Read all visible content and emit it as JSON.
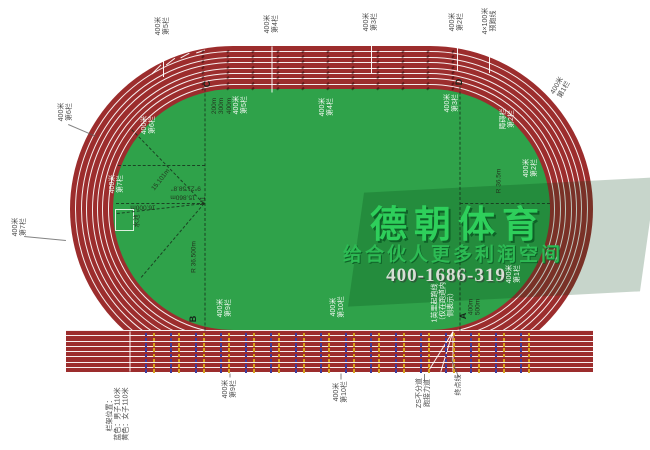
{
  "watermark": {
    "brand": "德朝体育",
    "slogan": "给合伙人更多利润空间",
    "phone": "400-1686-319"
  },
  "colors": {
    "track_red": "#9c2d2d",
    "field_green": "#2fa24a",
    "brand_green": "#2ecf5b",
    "hurdle_blue": "#3c3c9e",
    "hurdle_yellow": "#d7a31e"
  },
  "labels": [
    {
      "name": "label-400m-hurdle5-top",
      "cls": "out",
      "x": 163,
      "y": 26,
      "rot": -90,
      "lines": [
        "400米",
        "第5栏"
      ]
    },
    {
      "name": "label-400m-hurdle4-top",
      "cls": "out",
      "x": 272,
      "y": 24,
      "rot": -90,
      "lines": [
        "400米",
        "第4栏"
      ]
    },
    {
      "name": "label-400m-hurdle3-top",
      "cls": "out",
      "x": 371,
      "y": 22,
      "rot": -90,
      "lines": [
        "400米",
        "第3栏"
      ]
    },
    {
      "name": "label-400m-hurdle2-top",
      "cls": "out",
      "x": 457,
      "y": 22,
      "rot": -90,
      "lines": [
        "400米",
        "第2栏"
      ]
    },
    {
      "name": "label-4x100m-relay",
      "cls": "out",
      "x": 490,
      "y": 21,
      "rot": -90,
      "lines": [
        "4×100米",
        "预跑线"
      ]
    },
    {
      "name": "label-400m-hurdle6-left",
      "cls": "out",
      "x": 66,
      "y": 112,
      "rot": -90,
      "lines": [
        "400米",
        "第6栏"
      ]
    },
    {
      "name": "label-400m-hurdle7-left",
      "cls": "out",
      "x": 20,
      "y": 227,
      "rot": -90,
      "lines": [
        "400米",
        "第7栏"
      ]
    },
    {
      "name": "label-400m-hurdle1-track",
      "cls": "out",
      "x": 561,
      "y": 88,
      "rot": -60,
      "lines": [
        "400米",
        "第1栏"
      ]
    },
    {
      "name": "label-400m-hurdle9-bottom",
      "cls": "out",
      "x": 230,
      "y": 389,
      "rot": -90,
      "lines": [
        "400米",
        "第9栏"
      ]
    },
    {
      "name": "label-400m-hurdle10-bottom",
      "cls": "out",
      "x": 341,
      "y": 392,
      "rot": -90,
      "lines": [
        "400米",
        "第10栏"
      ]
    },
    {
      "name": "label-zs-relay-lane",
      "cls": "out",
      "x": 424,
      "y": 393,
      "rot": -90,
      "lines": [
        "ZS不分道",
        "跑接力道"
      ]
    },
    {
      "name": "label-finish-line",
      "cls": "out",
      "x": 459,
      "y": 385,
      "rot": -90,
      "lines": [
        "终点线"
      ]
    },
    {
      "name": "label-hurdle-legend",
      "cls": "out",
      "x": 118,
      "y": 414,
      "rot": -90,
      "lines": [
        "栏架位置：",
        "蓝色：男子110米",
        "黄色：女子110米"
      ]
    },
    {
      "name": "label-400m-hurdle6-in",
      "cls": "in",
      "x": 149,
      "y": 125,
      "rot": -90,
      "lines": [
        "400米",
        "第6栏"
      ]
    },
    {
      "name": "label-400m-hurdle7-in",
      "cls": "in",
      "x": 117,
      "y": 184,
      "rot": -90,
      "lines": [
        "400米",
        "第7栏"
      ]
    },
    {
      "name": "label-400m-hurdle5-in",
      "cls": "in",
      "x": 241,
      "y": 105,
      "rot": -90,
      "lines": [
        "400米",
        "第5栏"
      ]
    },
    {
      "name": "label-400m-hurdle4-in",
      "cls": "in",
      "x": 327,
      "y": 107,
      "rot": -90,
      "lines": [
        "400米",
        "第4栏"
      ]
    },
    {
      "name": "label-400m-hurdle3-in",
      "cls": "in",
      "x": 452,
      "y": 103,
      "rot": -90,
      "lines": [
        "400米",
        "第3栏"
      ]
    },
    {
      "name": "label-steeple-hurdle2-in",
      "cls": "in",
      "x": 508,
      "y": 119,
      "rot": -90,
      "lines": [
        "障碍栏",
        "第2栏"
      ]
    },
    {
      "name": "label-400m-hurdle2-in",
      "cls": "in",
      "x": 531,
      "y": 168,
      "rot": -90,
      "lines": [
        "400米",
        "第2栏"
      ]
    },
    {
      "name": "label-400m-hurdle1-in",
      "cls": "in",
      "x": 514,
      "y": 274,
      "rot": -90,
      "lines": [
        "400米",
        "第1栏"
      ]
    },
    {
      "name": "label-400m-hurdle9-in",
      "cls": "in",
      "x": 225,
      "y": 308,
      "rot": -90,
      "lines": [
        "400米",
        "第9栏"
      ]
    },
    {
      "name": "label-400m-hurdle10-in",
      "cls": "in",
      "x": 338,
      "y": 307,
      "rot": -90,
      "lines": [
        "400米",
        "第10栏"
      ]
    },
    {
      "name": "label-1mile-start",
      "cls": "in",
      "x": 443,
      "y": 303,
      "rot": -90,
      "lines": [
        "1英里起跑线",
        "（仅在跑道内",
        "侧表示）"
      ]
    },
    {
      "name": "point-c",
      "cls": "pt",
      "x": 207,
      "y": 84,
      "rot": -90,
      "lines": [
        "C"
      ]
    },
    {
      "name": "point-d",
      "cls": "pt",
      "x": 459,
      "y": 82,
      "rot": -90,
      "lines": [
        "D"
      ]
    },
    {
      "name": "point-b",
      "cls": "pt",
      "x": 193,
      "y": 319,
      "rot": -90,
      "lines": [
        "B"
      ]
    },
    {
      "name": "point-a",
      "cls": "pt",
      "x": 463,
      "y": 316,
      "rot": -90,
      "lines": [
        "A"
      ]
    },
    {
      "name": "label-c-distances",
      "cls": "ann",
      "x": 222,
      "y": 106,
      "rot": -90,
      "lines": [
        "200m",
        "300m",
        "400m"
      ]
    },
    {
      "name": "label-a-distances",
      "cls": "ann",
      "x": 475,
      "y": 307,
      "rot": -90,
      "lines": [
        "400m",
        "500m"
      ]
    },
    {
      "name": "label-radius-left",
      "cls": "ann",
      "x": 194,
      "y": 257,
      "rot": -90,
      "lines": [
        "R  36.500m"
      ]
    },
    {
      "name": "label-radius-right",
      "cls": "ann",
      "x": 499,
      "y": 181,
      "rot": -90,
      "lines": [
        "R 36.5m"
      ]
    },
    {
      "name": "label-m1",
      "cls": "ann",
      "x": 203,
      "y": 201,
      "rot": -90,
      "lines": [
        "M1"
      ]
    },
    {
      "name": "label-dim-15101",
      "cls": "ann",
      "x": 161,
      "y": 180,
      "rot": -52,
      "lines": [
        "15.101m"
      ]
    },
    {
      "name": "label-dim-15860",
      "cls": "ann",
      "x": 183,
      "y": 197,
      "rot": 180,
      "lines": [
        "15.860m"
      ]
    },
    {
      "name": "label-dim-16000",
      "cls": "ann",
      "x": 143,
      "y": 207,
      "rot": 180,
      "lines": [
        "16.000m"
      ]
    },
    {
      "name": "label-angle",
      "cls": "ann",
      "x": 186,
      "y": 188,
      "rot": 180,
      "lines": [
        "9°21'58.8\""
      ]
    },
    {
      "name": "label-water-pit",
      "cls": "ann",
      "x": 137,
      "y": 221,
      "rot": -90,
      "lines": [
        "水池"
      ]
    }
  ]
}
